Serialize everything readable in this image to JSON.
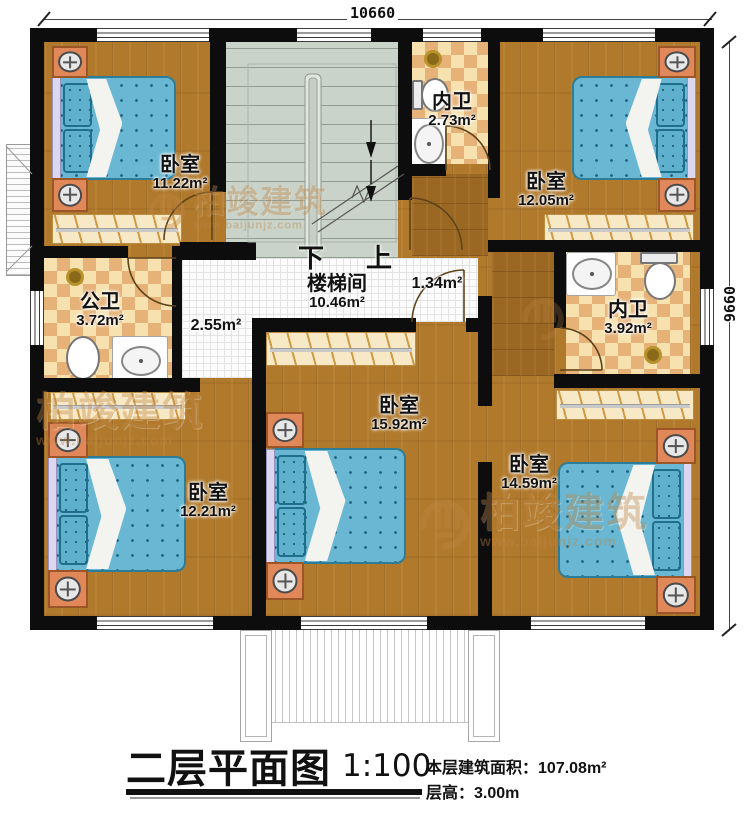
{
  "dims": {
    "top": "10660",
    "right": "9660"
  },
  "rooms": {
    "bed_tl": {
      "name": "卧室",
      "area": "11.22m²"
    },
    "bath_top": {
      "name": "内卫",
      "area": "2.73m²"
    },
    "bed_tr": {
      "name": "卧室",
      "area": "12.05m²"
    },
    "bath_public": {
      "name": "公卫",
      "area": "3.72m²"
    },
    "stairwell": {
      "name": "楼梯间",
      "area": "10.46m²"
    },
    "hall_small": {
      "area": "1.34m²"
    },
    "hall_left": {
      "area": "2.55m²"
    },
    "bath_right": {
      "name": "内卫",
      "area": "3.92m²"
    },
    "bed_center": {
      "name": "卧室",
      "area": "15.92m²"
    },
    "bed_bl": {
      "name": "卧室",
      "area": "12.21m²"
    },
    "bed_br": {
      "name": "卧室",
      "area": "14.59m²"
    }
  },
  "stairs": {
    "down": "下",
    "up": "上"
  },
  "title": {
    "name": "二层平面图",
    "scale": "1:100",
    "area_label": "本层建筑面积：",
    "area_value": "107.08m²",
    "height_label": "层高：",
    "height_value": "3.00m"
  },
  "watermark": {
    "brand": "柏竣建筑",
    "url": "www.baijunjz.com"
  },
  "colors": {
    "wall": "#0d0d0d",
    "wood": "#b0792c",
    "wood_corridor": "#9a6823",
    "tile_light": "#f7e2af",
    "tile_dark": "#e6b277",
    "bed": "#69b7d2",
    "stairs": "#c9d3c9",
    "nightstand": "#e1885a",
    "watermark": "#c08744"
  }
}
